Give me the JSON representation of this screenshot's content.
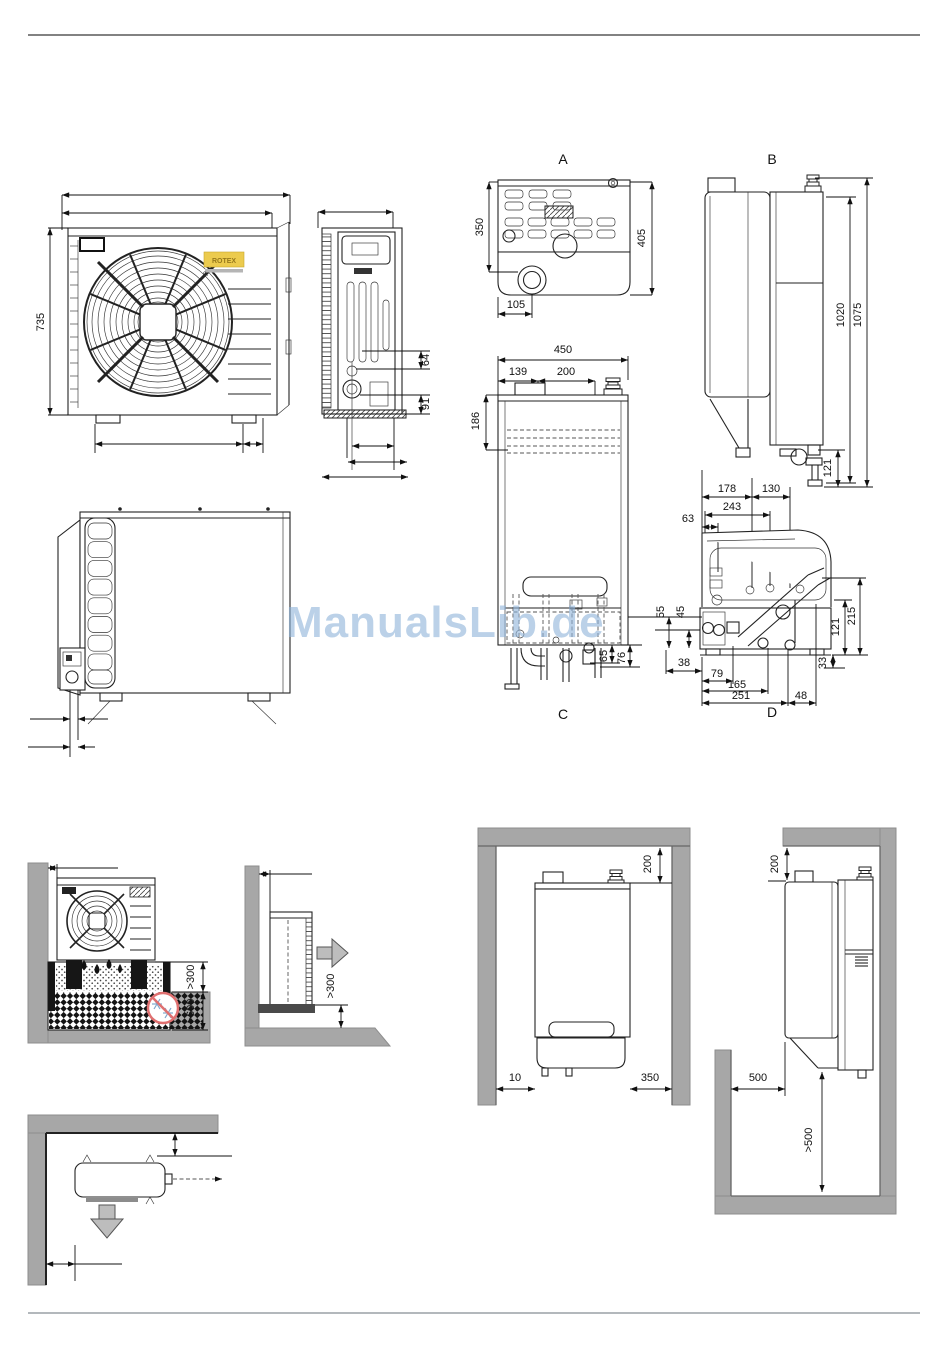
{
  "watermark": {
    "text": "ManualsLib.de"
  },
  "brand": {
    "name": "ROTEX",
    "mark": "0."
  },
  "outdoor_front": {
    "height": "735"
  },
  "outdoor_side": {
    "pipe_offset_1": "64",
    "pipe_offset_2": "91"
  },
  "view_a": {
    "label": "A",
    "dim_350": "350",
    "dim_405": "405",
    "dim_105": "105"
  },
  "view_b": {
    "label": "B",
    "dim_1020": "1020",
    "dim_1075": "1075",
    "dim_121": "121",
    "dim_178": "178",
    "dim_130": "130"
  },
  "view_c": {
    "label": "C",
    "dim_450": "450",
    "dim_139": "139",
    "dim_200": "200",
    "dim_186": "186",
    "dim_65": "65",
    "dim_76": "76"
  },
  "view_d": {
    "label": "D",
    "dim_243": "243",
    "dim_63": "63",
    "dim_55": "55",
    "dim_45": "45",
    "dim_38": "38",
    "dim_79": "79",
    "dim_165": "165",
    "dim_251": "251",
    "dim_48": "48",
    "dim_121": "121",
    "dim_215": "215",
    "dim_33": "33"
  },
  "install_ground": {
    "clearance_front": ">300",
    "bed_depth": ">600"
  },
  "install_wall": {
    "clearance_front": ">300"
  },
  "install_niche": {
    "clearance_top": "200",
    "clearance_left": "10",
    "clearance_right": "350"
  },
  "install_side": {
    "clearance_top": "200",
    "clearance_front": "500",
    "clearance_below": ">500"
  }
}
